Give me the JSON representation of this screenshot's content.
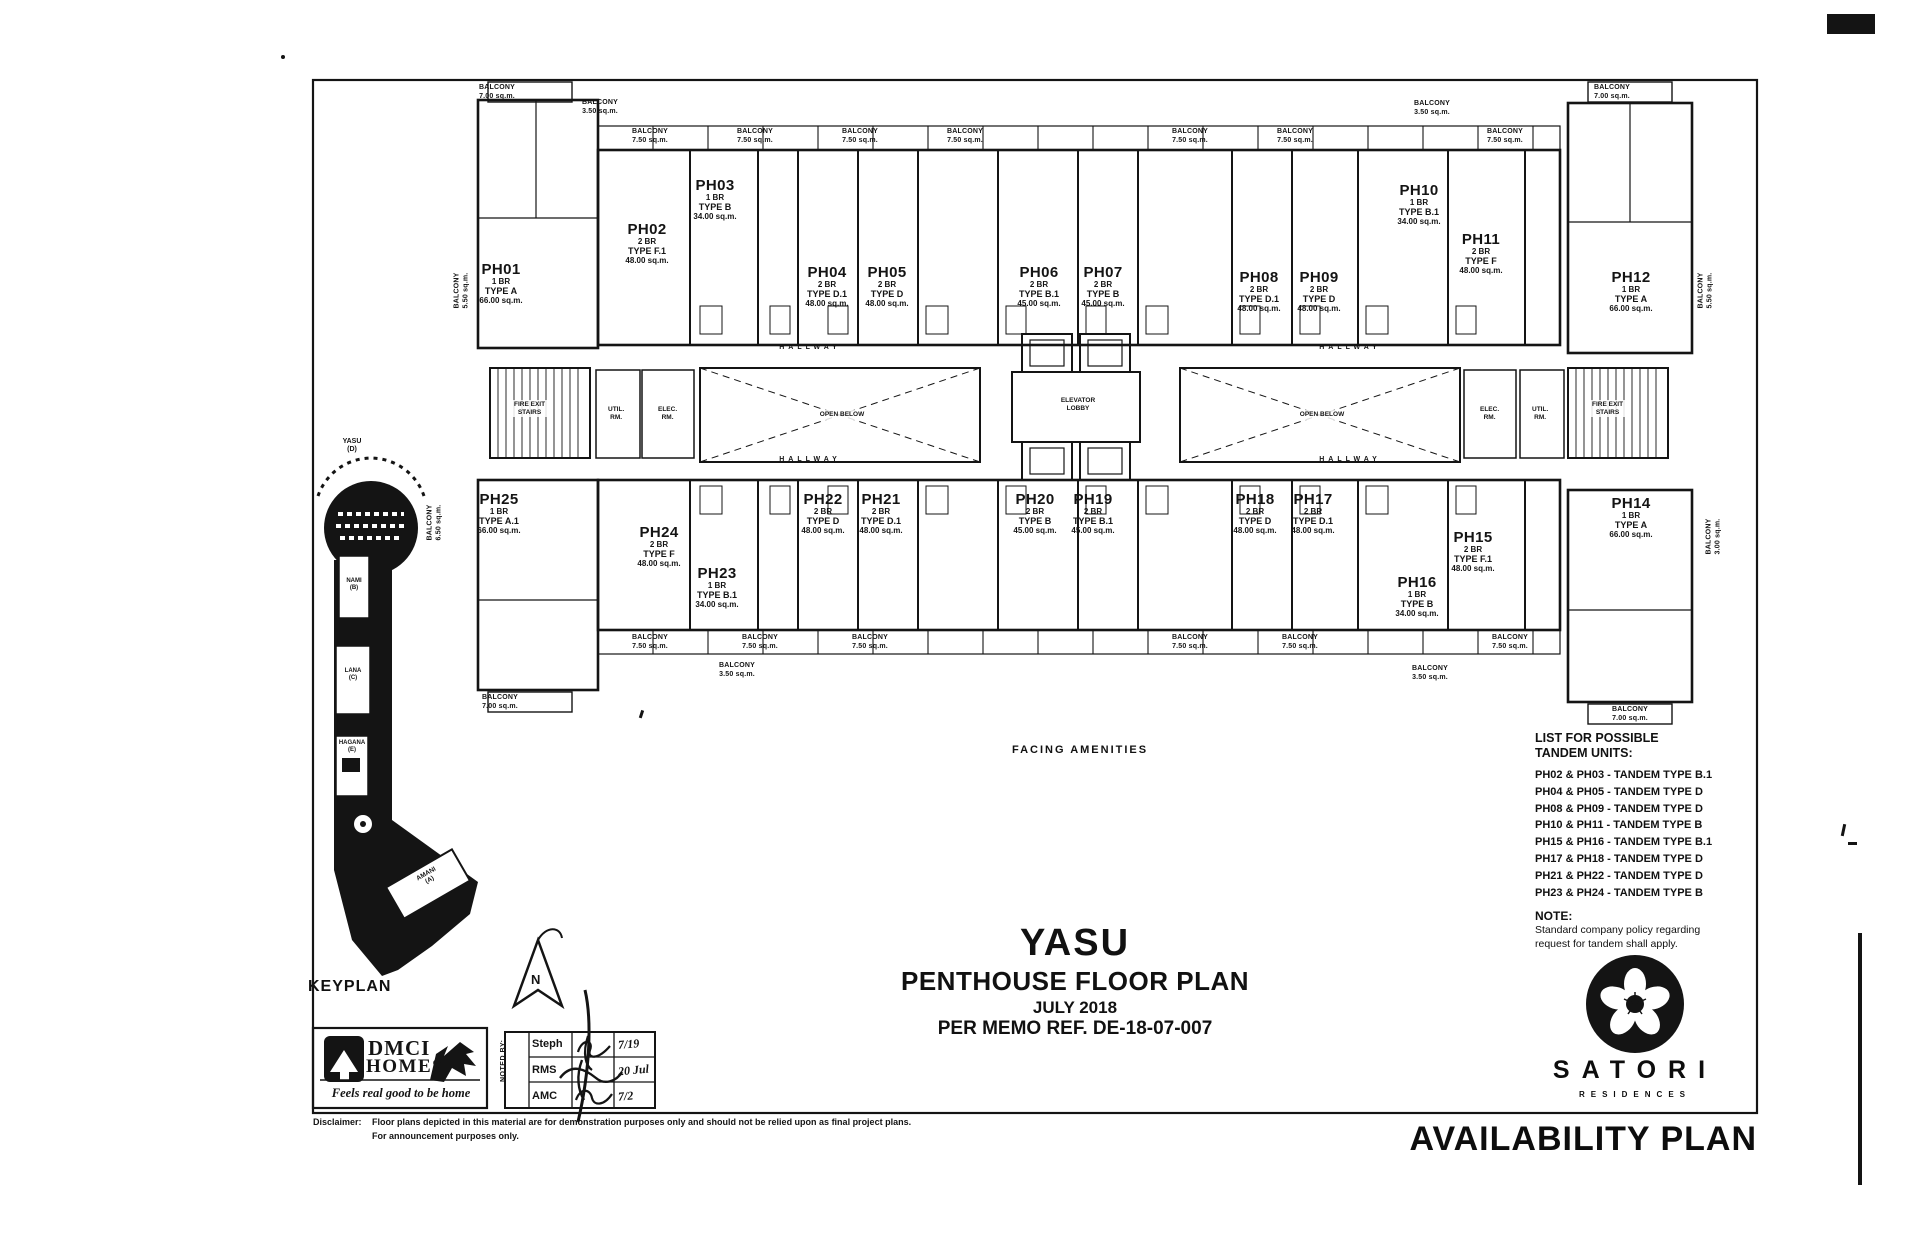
{
  "sheet": {
    "availability_plan": "AVAILABILITY PLAN",
    "keyplan_label": "KEYPLAN",
    "facing_amenities": "FACING AMENITIES"
  },
  "title_block": {
    "project": "YASU",
    "plan_title": "PENTHOUSE FLOOR PLAN",
    "date": "JULY 2018",
    "memo": "PER MEMO REF. DE-18-07-007"
  },
  "plan": {
    "labels": {
      "hallway": "HALLWAY",
      "elevator_lobby": "ELEVATOR\nLOBBY",
      "open_below": "OPEN BELOW",
      "fire_exit_stairs": "FIRE EXIT\nSTAIRS",
      "util_rm": "UTIL.\nRM.",
      "elec_rm": "ELEC.\nRM."
    },
    "units": [
      {
        "id": "PH01",
        "br": "1 BR",
        "type": "TYPE A",
        "area": "66.00 sq.m."
      },
      {
        "id": "PH02",
        "br": "2 BR",
        "type": "TYPE F.1",
        "area": "48.00 sq.m."
      },
      {
        "id": "PH03",
        "br": "1 BR",
        "type": "TYPE B",
        "area": "34.00 sq.m."
      },
      {
        "id": "PH04",
        "br": "2 BR",
        "type": "TYPE D.1",
        "area": "48.00 sq.m."
      },
      {
        "id": "PH05",
        "br": "2 BR",
        "type": "TYPE D",
        "area": "48.00 sq.m."
      },
      {
        "id": "PH06",
        "br": "2 BR",
        "type": "TYPE B.1",
        "area": "45.00 sq.m."
      },
      {
        "id": "PH07",
        "br": "2 BR",
        "type": "TYPE B",
        "area": "45.00 sq.m."
      },
      {
        "id": "PH08",
        "br": "2 BR",
        "type": "TYPE D.1",
        "area": "48.00 sq.m."
      },
      {
        "id": "PH09",
        "br": "2 BR",
        "type": "TYPE D",
        "area": "48.00 sq.m."
      },
      {
        "id": "PH10",
        "br": "1 BR",
        "type": "TYPE B.1",
        "area": "34.00 sq.m."
      },
      {
        "id": "PH11",
        "br": "2 BR",
        "type": "TYPE F",
        "area": "48.00 sq.m."
      },
      {
        "id": "PH12",
        "br": "1 BR",
        "type": "TYPE A",
        "area": "66.00 sq.m."
      },
      {
        "id": "PH25",
        "br": "1 BR",
        "type": "TYPE A.1",
        "area": "66.00 sq.m."
      },
      {
        "id": "PH24",
        "br": "2 BR",
        "type": "TYPE F",
        "area": "48.00 sq.m."
      },
      {
        "id": "PH23",
        "br": "1 BR",
        "type": "TYPE B.1",
        "area": "34.00 sq.m."
      },
      {
        "id": "PH22",
        "br": "2 BR",
        "type": "TYPE D",
        "area": "48.00 sq.m."
      },
      {
        "id": "PH21",
        "br": "2 BR",
        "type": "TYPE D.1",
        "area": "48.00 sq.m."
      },
      {
        "id": "PH20",
        "br": "2 BR",
        "type": "TYPE B",
        "area": "45.00 sq.m."
      },
      {
        "id": "PH19",
        "br": "2 BR",
        "type": "TYPE B.1",
        "area": "45.00 sq.m."
      },
      {
        "id": "PH18",
        "br": "2 BR",
        "type": "TYPE D",
        "area": "48.00 sq.m."
      },
      {
        "id": "PH17",
        "br": "2 BR",
        "type": "TYPE D.1",
        "area": "48.00 sq.m."
      },
      {
        "id": "PH16",
        "br": "1 BR",
        "type": "TYPE B",
        "area": "34.00 sq.m."
      },
      {
        "id": "PH15",
        "br": "2 BR",
        "type": "TYPE F.1",
        "area": "48.00 sq.m."
      },
      {
        "id": "PH14",
        "br": "1 BR",
        "type": "TYPE A",
        "area": "66.00 sq.m."
      }
    ],
    "balcony_labels": [
      "BALCONY\n7.00 sq.m.",
      "BALCONY\n3.50 sq.m.",
      "BALCONY\n7.50 sq.m.",
      "BALCONY\n7.50 sq.m.",
      "BALCONY\n7.50 sq.m.",
      "BALCONY\n7.50 sq.m.",
      "BALCONY\n7.50 sq.m.",
      "BALCONY\n7.50 sq.m.",
      "BALCONY\n7.50 sq.m.",
      "BALCONY\n3.50 sq.m.",
      "BALCONY\n7.00 sq.m.",
      "BALCONY\n5.50 sq.m.",
      "BALCONY\n5.50 sq.m.",
      "BALCONY\n7.00 sq.m.",
      "BALCONY\n3.50 sq.m.",
      "BALCONY\n7.50 sq.m.",
      "BALCONY\n7.50 sq.m.",
      "BALCONY\n7.50 sq.m.",
      "BALCONY\n7.50 sq.m.",
      "BALCONY\n7.50 sq.m.",
      "BALCONY\n7.50 sq.m.",
      "BALCONY\n3.50 sq.m.",
      "BALCONY\n7.00 sq.m.",
      "BALCONY\n6.50 sq.m.",
      "BALCONY\n3.00 sq.m."
    ]
  },
  "keyplan": {
    "buildings": [
      {
        "label": "YASU\n(D)"
      },
      {
        "label": "NAMI\n(B)"
      },
      {
        "label": "LANA\n(C)"
      },
      {
        "label": "HAGANA\n(E)"
      },
      {
        "label": "AMANI\n(A)"
      }
    ],
    "north": "N"
  },
  "tandem": {
    "heading_line1": "LIST FOR POSSIBLE",
    "heading_line2": "TANDEM UNITS:",
    "items": [
      "PH02 & PH03 - TANDEM TYPE B.1",
      "PH04 & PH05 - TANDEM TYPE D",
      "PH08 & PH09 - TANDEM TYPE D",
      "PH10 & PH11 - TANDEM TYPE B",
      "PH15 & PH16 - TANDEM TYPE B.1",
      "PH17 & PH18 - TANDEM TYPE D",
      "PH21 & PH22 - TANDEM TYPE D",
      "PH23 & PH24 - TANDEM TYPE B"
    ],
    "note_heading": "NOTE:",
    "note_line1": "Standard company policy regarding",
    "note_line2": "request for tandem shall apply."
  },
  "noted_by": {
    "label": "NOTED BY:",
    "rows": [
      {
        "name": "Steph",
        "date": "7/19"
      },
      {
        "name": "RMS",
        "date": "20 Jul"
      },
      {
        "name": "AMC",
        "date": "7/2"
      }
    ]
  },
  "disclaimer": {
    "label": "Disclaimer:",
    "line1": "Floor plans depicted in this material are for demonstration purposes only and should not be relied upon as final project plans.",
    "line2": "For announcement purposes only."
  },
  "branding": {
    "dmci_line1": "DMCI",
    "dmci_line2": "HOMES",
    "dmci_tagline": "Feels real good to be home",
    "satori": "SATORI",
    "satori_sub": "RESIDENCES"
  },
  "colors": {
    "ink": "#141414",
    "paper": "#ffffff"
  }
}
